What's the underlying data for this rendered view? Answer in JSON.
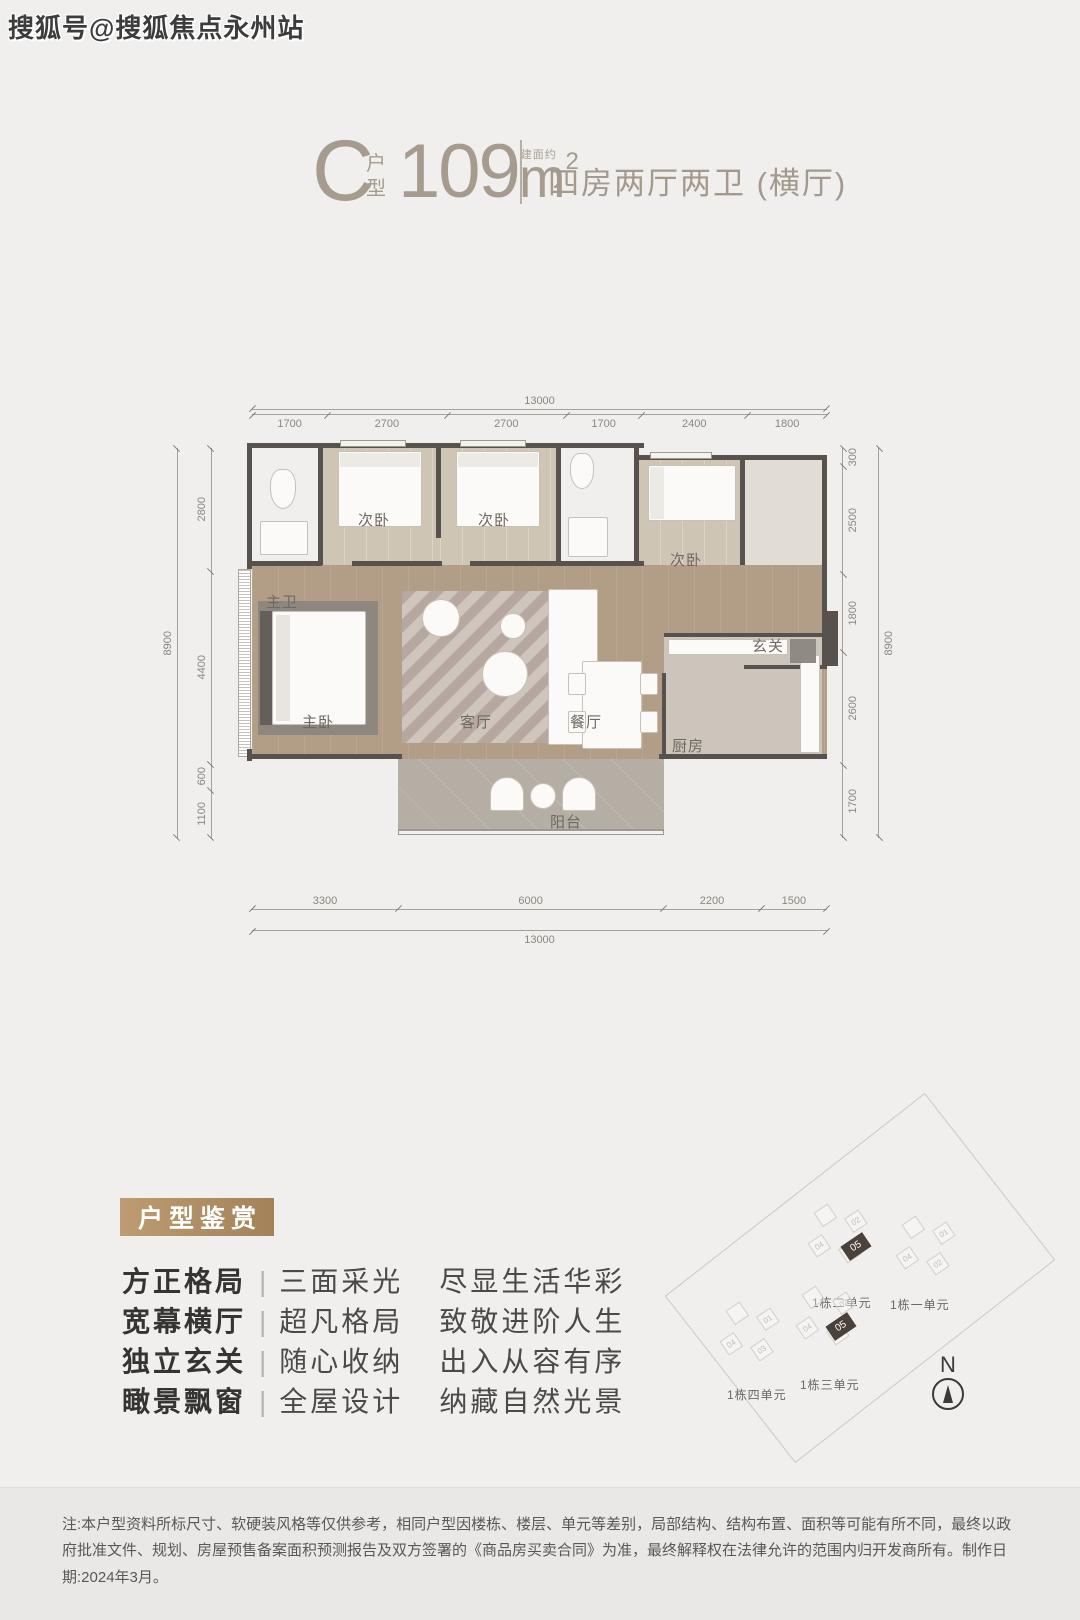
{
  "watermark": "搜狐号@搜狐焦点永州站",
  "header": {
    "type_letter": "C",
    "type_label_top": "户",
    "type_label_bottom": "型",
    "area_prefix": "建面约",
    "area_value": "109",
    "area_unit": "m",
    "area_sup": "2",
    "layout_desc": "四房两厅两卫 (横厅)"
  },
  "floorplan": {
    "rooms": {
      "master_bath": "主卫",
      "bedroom_a": "次卧",
      "bedroom_b": "次卧",
      "bedroom_c": "次卧",
      "foyer": "玄关",
      "master_bedroom": "主卧",
      "living": "客厅",
      "dining": "餐厅",
      "kitchen": "厨房",
      "balcony": "阳台"
    },
    "dims": {
      "top_total": "13000",
      "top": [
        "1700",
        "2700",
        "2700",
        "1700",
        "2400",
        "1800"
      ],
      "left_total": "8900",
      "left": [
        "2800",
        "4400",
        "600",
        "1100"
      ],
      "right": [
        "300",
        "2500",
        "1800",
        "2600",
        "1700"
      ],
      "right_total": "8900",
      "bottom": [
        "3300",
        "6000",
        "2200",
        "1500"
      ],
      "bottom_total": "13000"
    }
  },
  "appreciation": {
    "badge": "户型鉴赏",
    "features": [
      {
        "title": "方正格局",
        "divider": "|",
        "middle": "三面采光",
        "desc": "尽显生活华彩"
      },
      {
        "title": "宽幕横厅",
        "divider": "|",
        "middle": "超凡格局",
        "desc": "致敬进阶人生"
      },
      {
        "title": "独立玄关",
        "divider": "|",
        "middle": "随心收纳",
        "desc": "出入从容有序"
      },
      {
        "title": "瞰景飘窗",
        "divider": "|",
        "middle": "全屋设计",
        "desc": "纳藏自然光景"
      }
    ]
  },
  "siteplan": {
    "clusters": [
      {
        "label": "1栋二单元",
        "badge": "05"
      },
      {
        "label": "1栋一单元"
      },
      {
        "label": "1栋三单元",
        "badge": "05"
      },
      {
        "label": "1栋四单元"
      }
    ],
    "unit_numbers": [
      "01",
      "02",
      "03",
      "04"
    ],
    "compass_label": "N"
  },
  "footer": {
    "note": "注:本户型资料所标尺寸、软硬装风格等仅供参考，相同户型因楼栋、楼层、单元等差别，局部结构、结构布置、面积等可能有所不同，最终以政府批准文件、规划、房屋预售备案面积预测报告及双方签署的《商品房买卖合同》为准，最终解释权在法律允许的范围内归开发商所有。制作日期:2024年3月。"
  },
  "colors": {
    "background": "#f0efed",
    "accent_gold": "#ad8a5d",
    "wall": "#57524d",
    "wood_floor": "#b29d86",
    "title_text": "#a59c8f"
  }
}
